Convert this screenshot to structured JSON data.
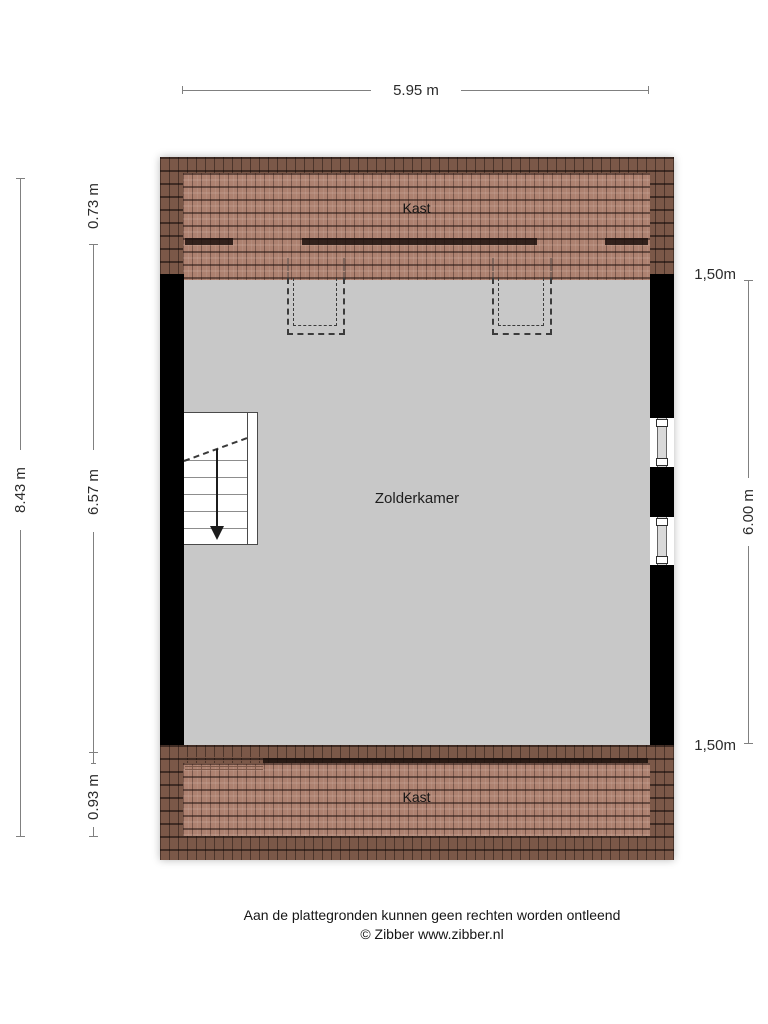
{
  "plan": {
    "room_top": "Kast",
    "room_main": "Zolderkamer",
    "room_bottom": "Kast",
    "dim_width_top": "5.95 m",
    "dim_left_total": "8.43 m",
    "dim_left_upper": "0.73 m",
    "dim_left_middle": "6.57 m",
    "dim_left_lower": "0.93 m",
    "dim_right_height": "6.00 m",
    "headroom_top": "1,50m",
    "headroom_bottom": "1,50m",
    "colors": {
      "roof_light": "#ad8170",
      "roof_dark": "#7b5848",
      "interior_gray": "#c8c8c8",
      "wall_black": "#000000"
    }
  },
  "footer": {
    "disclaimer": "Aan de plattegronden kunnen geen rechten worden ontleend",
    "copyright": "© Zibber www.zibber.nl"
  }
}
